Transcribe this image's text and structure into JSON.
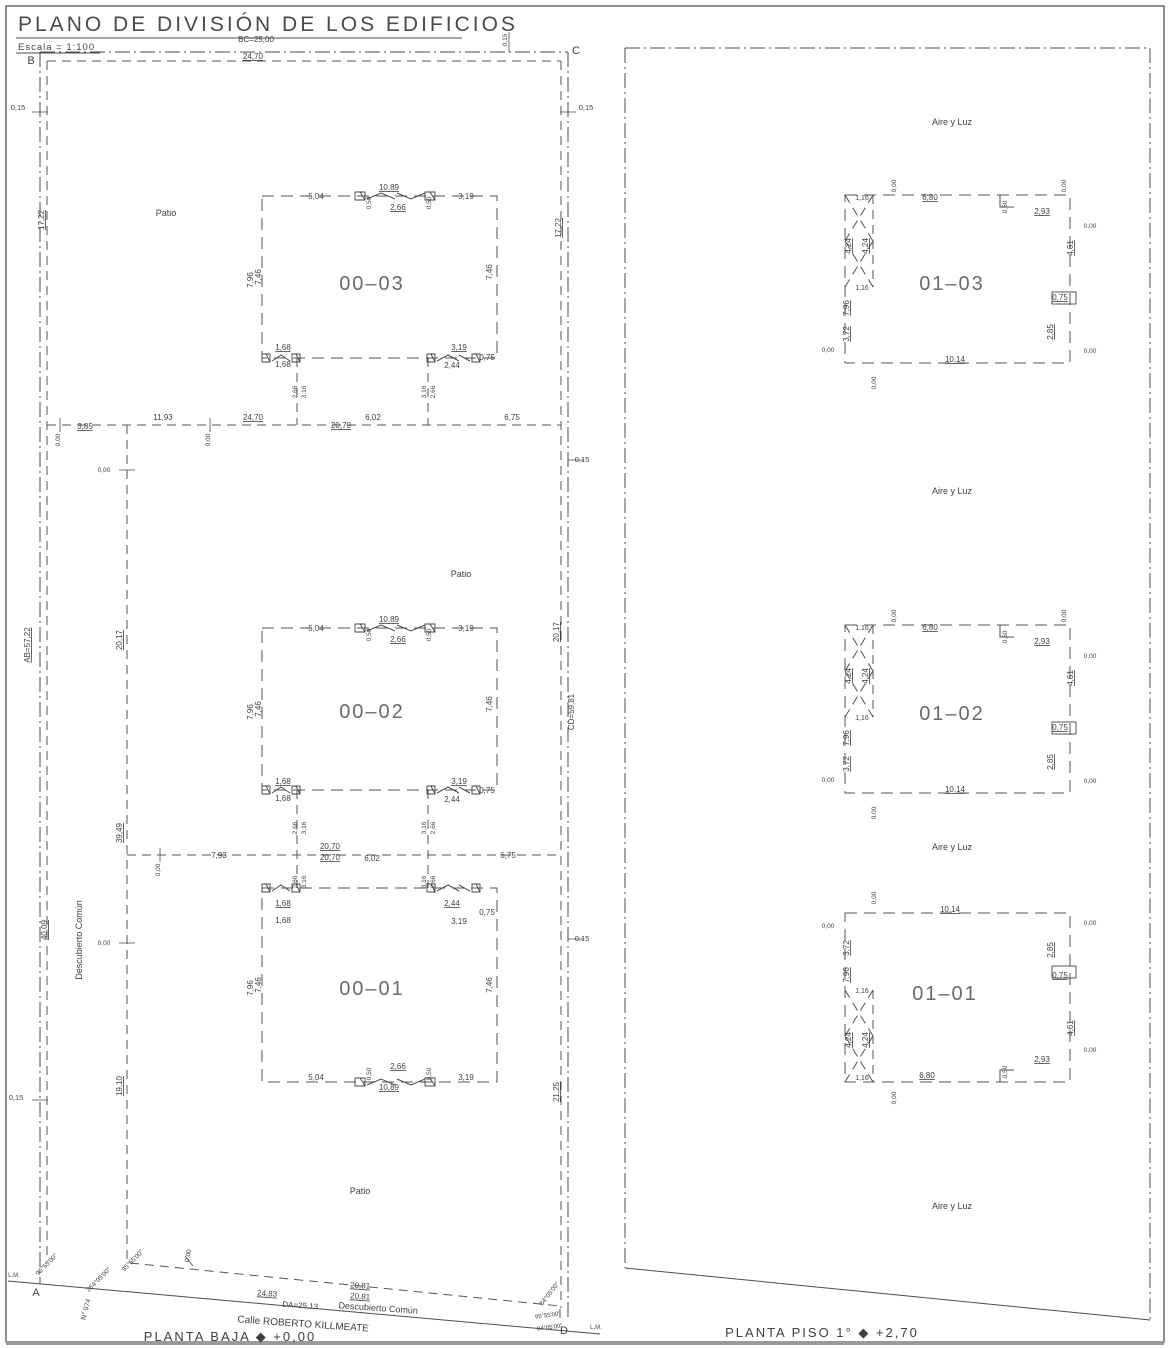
{
  "title": "PLANO DE DIVISIÓN DE LOS EDIFICIOS",
  "scale_label": "Escala = 1:100",
  "captions": {
    "left": "PLANTA BAJA ◆ +0,00",
    "right": "PLANTA PISO 1° ◆ +2,70"
  },
  "colors": {
    "ink": "#3f3f3f",
    "line": "#4d4d4d",
    "bg": "#ffffff"
  },
  "units_ground": [
    "00–01",
    "00–02",
    "00–03"
  ],
  "units_first": [
    "01–01",
    "01–02",
    "01–03"
  ],
  "labels": [
    {
      "t": "B",
      "x": 31,
      "y": 64,
      "s": 11,
      "n": "corner-b"
    },
    {
      "t": "C",
      "x": 576,
      "y": 54,
      "s": 11,
      "n": "corner-c"
    },
    {
      "t": "A",
      "x": 36,
      "y": 1296,
      "s": 11,
      "n": "corner-a"
    },
    {
      "t": "D",
      "x": 564,
      "y": 1334,
      "s": 11,
      "n": "corner-d"
    },
    {
      "t": "L.M.",
      "x": 14,
      "y": 1277,
      "s": 6,
      "n": "lm-left"
    },
    {
      "t": "L.M.",
      "x": 596,
      "y": 1329,
      "s": 6,
      "n": "lm-right"
    },
    {
      "t": "BC=25,00",
      "x": 256,
      "y": 42,
      "n": "dim-bc"
    },
    {
      "t": "24,70",
      "x": 253,
      "y": 59,
      "u": 1
    },
    {
      "t": "0,15",
      "x": 507,
      "y": 40,
      "r": -90,
      "s": 6.5
    },
    {
      "t": "0,15",
      "x": 18,
      "y": 110,
      "s": 7.5
    },
    {
      "t": "17,22",
      "x": 44,
      "y": 220,
      "r": -90,
      "u": 1
    },
    {
      "t": "AB=57,22",
      "x": 30,
      "y": 645,
      "r": -90,
      "u": 1,
      "n": "dim-ab"
    },
    {
      "t": "40,09",
      "x": 47,
      "y": 930,
      "r": -90,
      "u": 1
    },
    {
      "t": "0,15",
      "x": 16,
      "y": 1100,
      "s": 7.5
    },
    {
      "t": "Descubierto Común",
      "x": 82,
      "y": 940,
      "r": -90,
      "s": 9,
      "n": "area-descubierto-comun"
    },
    {
      "t": "0,15",
      "x": 586,
      "y": 110,
      "s": 7.5
    },
    {
      "t": "17,22",
      "x": 561,
      "y": 228,
      "r": -90,
      "u": 1
    },
    {
      "t": "0,15",
      "x": 582,
      "y": 462,
      "s": 7.5
    },
    {
      "t": "20,17",
      "x": 559,
      "y": 632,
      "r": -90,
      "u": 1
    },
    {
      "t": "CD=59,81",
      "x": 574,
      "y": 712,
      "r": -90,
      "n": "dim-cd"
    },
    {
      "t": "0,15",
      "x": 582,
      "y": 941,
      "s": 7.5
    },
    {
      "t": "21,25",
      "x": 559,
      "y": 1092,
      "r": -90,
      "u": 1
    },
    {
      "t": "3,85",
      "x": 85,
      "y": 429,
      "u": 1
    },
    {
      "t": "0,00",
      "x": 60,
      "y": 440,
      "r": -90,
      "s": 6.5
    },
    {
      "t": "11,93",
      "x": 163,
      "y": 420
    },
    {
      "t": "0,00",
      "x": 210,
      "y": 440,
      "r": -90,
      "s": 6.5
    },
    {
      "t": "24,70",
      "x": 253,
      "y": 420,
      "u": 1
    },
    {
      "t": "20,70",
      "x": 341,
      "y": 428,
      "u": 1
    },
    {
      "t": "6,02",
      "x": 373,
      "y": 420
    },
    {
      "t": "6,75",
      "x": 512,
      "y": 420
    },
    {
      "t": "0,00",
      "x": 104,
      "y": 472,
      "s": 6.5
    },
    {
      "t": "20,17",
      "x": 122,
      "y": 640,
      "r": -90,
      "u": 1
    },
    {
      "t": "39,49",
      "x": 122,
      "y": 833,
      "r": -90,
      "u": 1
    },
    {
      "t": "0,00",
      "x": 104,
      "y": 945,
      "s": 6.5
    },
    {
      "t": "19,10",
      "x": 122,
      "y": 1086,
      "r": -90,
      "u": 1
    },
    {
      "t": "0,00",
      "x": 160,
      "y": 870,
      "r": -90,
      "s": 6.5
    },
    {
      "t": "7,93",
      "x": 219,
      "y": 858
    },
    {
      "t": "20,70",
      "x": 330,
      "y": 849,
      "u": 1
    },
    {
      "t": "20,70",
      "x": 330,
      "y": 860,
      "u": 1
    },
    {
      "t": "6,02",
      "x": 372,
      "y": 861
    },
    {
      "t": "6,75",
      "x": 508,
      "y": 858
    },
    {
      "t": "2,66",
      "x": 297,
      "y": 392,
      "r": -90,
      "s": 6.5
    },
    {
      "t": "3,16",
      "x": 306,
      "y": 392,
      "r": -90,
      "s": 6.5
    },
    {
      "t": "3,16",
      "x": 426,
      "y": 392,
      "r": -90,
      "s": 6.5
    },
    {
      "t": "2,66",
      "x": 435,
      "y": 392,
      "r": -90,
      "s": 6.5
    },
    {
      "t": "2,66",
      "x": 297,
      "y": 828,
      "r": -90,
      "s": 6.5
    },
    {
      "t": "3,16",
      "x": 306,
      "y": 828,
      "r": -90,
      "s": 6.5
    },
    {
      "t": "3,16",
      "x": 426,
      "y": 828,
      "r": -90,
      "s": 6.5
    },
    {
      "t": "2,66",
      "x": 435,
      "y": 828,
      "r": -90,
      "s": 6.5
    },
    {
      "t": "2,66",
      "x": 297,
      "y": 882,
      "r": -90,
      "s": 6.5
    },
    {
      "t": "3,16",
      "x": 306,
      "y": 882,
      "r": -90,
      "s": 6.5
    },
    {
      "t": "3,16",
      "x": 426,
      "y": 882,
      "r": -90,
      "s": 6.5
    },
    {
      "t": "2,66",
      "x": 435,
      "y": 882,
      "r": -90,
      "s": 6.5
    },
    {
      "t": "5,04",
      "x": 316,
      "y": 199
    },
    {
      "t": "10,89",
      "x": 389,
      "y": 190,
      "u": 1
    },
    {
      "t": "0,50",
      "x": 371,
      "y": 203,
      "r": -90,
      "s": 6.5
    },
    {
      "t": "2,66",
      "x": 398,
      "y": 210,
      "u": 1
    },
    {
      "t": "0,50",
      "x": 431,
      "y": 203,
      "r": -90,
      "s": 6.5
    },
    {
      "t": "3,19",
      "x": 466,
      "y": 199
    },
    {
      "t": "7,96",
      "x": 253,
      "y": 280,
      "r": -90
    },
    {
      "t": "7,46",
      "x": 261,
      "y": 277,
      "r": -90
    },
    {
      "t": "7,46",
      "x": 492,
      "y": 272,
      "r": -90
    },
    {
      "t": "1,68",
      "x": 283,
      "y": 350,
      "u": 1
    },
    {
      "t": "1,68",
      "x": 283,
      "y": 367
    },
    {
      "t": "3,19",
      "x": 459,
      "y": 350,
      "u": 1
    },
    {
      "t": "2,44",
      "x": 452,
      "y": 368
    },
    {
      "t": "0,75",
      "x": 487,
      "y": 360
    },
    {
      "t": "00–03",
      "x": 372,
      "y": 290,
      "s": 20,
      "n": "unit-label-00-03"
    },
    {
      "t": "5,04",
      "x": 316,
      "y": 631
    },
    {
      "t": "10,89",
      "x": 389,
      "y": 622,
      "u": 1
    },
    {
      "t": "0,50",
      "x": 371,
      "y": 635,
      "r": -90,
      "s": 6.5
    },
    {
      "t": "2,66",
      "x": 398,
      "y": 642,
      "u": 1
    },
    {
      "t": "0,50",
      "x": 431,
      "y": 635,
      "r": -90,
      "s": 6.5
    },
    {
      "t": "3,19",
      "x": 466,
      "y": 631
    },
    {
      "t": "7,96",
      "x": 253,
      "y": 712,
      "r": -90
    },
    {
      "t": "7,46",
      "x": 261,
      "y": 709,
      "r": -90
    },
    {
      "t": "7,46",
      "x": 492,
      "y": 704,
      "r": -90
    },
    {
      "t": "1,68",
      "x": 283,
      "y": 784,
      "u": 1
    },
    {
      "t": "1,68",
      "x": 283,
      "y": 801
    },
    {
      "t": "3,19",
      "x": 459,
      "y": 784,
      "u": 1
    },
    {
      "t": "2,44",
      "x": 452,
      "y": 802
    },
    {
      "t": "0,75",
      "x": 487,
      "y": 793
    },
    {
      "t": "00–02",
      "x": 372,
      "y": 718,
      "s": 20,
      "n": "unit-label-00-02"
    },
    {
      "t": "1,68",
      "x": 283,
      "y": 906,
      "u": 1
    },
    {
      "t": "1,68",
      "x": 283,
      "y": 923
    },
    {
      "t": "2,44",
      "x": 452,
      "y": 906,
      "u": 1
    },
    {
      "t": "3,19",
      "x": 459,
      "y": 924
    },
    {
      "t": "0,75",
      "x": 487,
      "y": 915
    },
    {
      "t": "7,96",
      "x": 253,
      "y": 988,
      "r": -90
    },
    {
      "t": "7,46",
      "x": 261,
      "y": 985,
      "r": -90
    },
    {
      "t": "7,46",
      "x": 492,
      "y": 985,
      "r": -90
    },
    {
      "t": "5,04",
      "x": 316,
      "y": 1080
    },
    {
      "t": "2,66",
      "x": 398,
      "y": 1069,
      "u": 1
    },
    {
      "t": "0,50",
      "x": 371,
      "y": 1074,
      "r": -90,
      "s": 6.5
    },
    {
      "t": "0,50",
      "x": 431,
      "y": 1074,
      "r": -90,
      "s": 6.5
    },
    {
      "t": "10,89",
      "x": 389,
      "y": 1090,
      "u": 1
    },
    {
      "t": "3,19",
      "x": 466,
      "y": 1080
    },
    {
      "t": "00–01",
      "x": 372,
      "y": 995,
      "s": 20,
      "n": "unit-label-00-01"
    },
    {
      "t": "Patio",
      "x": 166,
      "y": 216,
      "s": 9,
      "n": "area-patio-1"
    },
    {
      "t": "Patio",
      "x": 461,
      "y": 577,
      "s": 9,
      "n": "area-patio-2"
    },
    {
      "t": "Patio",
      "x": 360,
      "y": 1194,
      "s": 9,
      "n": "area-patio-3"
    },
    {
      "t": "0,00",
      "x": 190,
      "y": 1256,
      "r": -80,
      "s": 6.5
    },
    {
      "t": "95°55'00\"",
      "x": 48,
      "y": 1266,
      "r": -45,
      "s": 6.5
    },
    {
      "t": "264°05'00\"",
      "x": 100,
      "y": 1281,
      "r": -45,
      "s": 6.5
    },
    {
      "t": "95°55'00\"",
      "x": 134,
      "y": 1262,
      "r": -45,
      "s": 6.5
    },
    {
      "t": "N° 974",
      "x": 88,
      "y": 1310,
      "r": -75,
      "s": 7,
      "n": "street-number"
    },
    {
      "t": "24,83",
      "x": 267,
      "y": 1296,
      "u": 1,
      "r": 4
    },
    {
      "t": "DA=25,13",
      "x": 300,
      "y": 1308,
      "r": 4,
      "n": "dim-da"
    },
    {
      "t": "Calle ROBERTO KILLMEATE",
      "x": 303,
      "y": 1327,
      "r": 4,
      "s": 10,
      "n": "street-name"
    },
    {
      "t": "Descubierto Común",
      "x": 378,
      "y": 1311,
      "r": 4,
      "s": 9,
      "n": "area-descubierto-comun-2"
    },
    {
      "t": "20,81",
      "x": 360,
      "y": 1288,
      "u": 1,
      "r": 4
    },
    {
      "t": "20,81",
      "x": 360,
      "y": 1299,
      "u": 1,
      "r": 4
    },
    {
      "t": "84°05'00\"",
      "x": 551,
      "y": 1295,
      "r": -52,
      "s": 6.5
    },
    {
      "t": "95°55'00\"",
      "x": 548,
      "y": 1317,
      "r": -8,
      "s": 6
    },
    {
      "t": "84°05'00\"",
      "x": 550,
      "y": 1329,
      "r": -8,
      "s": 6
    },
    {
      "t": "Aire y Luz",
      "x": 952,
      "y": 125,
      "s": 9,
      "n": "area-aire-y-luz-1"
    },
    {
      "t": "Aire y Luz",
      "x": 952,
      "y": 494,
      "s": 9,
      "n": "area-aire-y-luz-2"
    },
    {
      "t": "Aire y Luz",
      "x": 952,
      "y": 850,
      "s": 9,
      "n": "area-aire-y-luz-3"
    },
    {
      "t": "Aire y Luz",
      "x": 952,
      "y": 1209,
      "s": 9,
      "n": "area-aire-y-luz-4"
    },
    {
      "t": "1,16",
      "x": 862,
      "y": 200,
      "s": 7
    },
    {
      "t": "0,00",
      "x": 896,
      "y": 186,
      "r": -90,
      "s": 6.5
    },
    {
      "t": "6,80",
      "x": 930,
      "y": 200,
      "u": 1
    },
    {
      "t": "0,50",
      "x": 1007,
      "y": 207,
      "r": -90,
      "s": 6.5
    },
    {
      "t": "2,93",
      "x": 1042,
      "y": 214,
      "u": 1
    },
    {
      "t": "0,00",
      "x": 1066,
      "y": 186,
      "r": -90,
      "s": 6.5
    },
    {
      "t": "0,00",
      "x": 1090,
      "y": 228,
      "s": 6.5
    },
    {
      "t": "4,61",
      "x": 1073,
      "y": 248,
      "r": -90,
      "u": 1
    },
    {
      "t": "0,75",
      "x": 1060,
      "y": 300,
      "u": 1
    },
    {
      "t": "2,85",
      "x": 1053,
      "y": 332,
      "r": -90,
      "u": 1
    },
    {
      "t": "0,00",
      "x": 1090,
      "y": 353,
      "s": 6.5
    },
    {
      "t": "10,14",
      "x": 955,
      "y": 362,
      "u": 1
    },
    {
      "t": "0,00",
      "x": 876,
      "y": 383,
      "r": -90,
      "s": 6.5
    },
    {
      "t": "4,24",
      "x": 851,
      "y": 246,
      "r": -90,
      "u": 1
    },
    {
      "t": "4,24",
      "x": 868,
      "y": 246,
      "r": -90,
      "u": 1
    },
    {
      "t": "1,16",
      "x": 862,
      "y": 290,
      "s": 7
    },
    {
      "t": "7,96",
      "x": 849,
      "y": 308,
      "r": -90,
      "u": 1
    },
    {
      "t": "3,72",
      "x": 849,
      "y": 334,
      "r": -90,
      "u": 1
    },
    {
      "t": "0,00",
      "x": 828,
      "y": 352,
      "s": 6.5
    },
    {
      "t": "01–03",
      "x": 952,
      "y": 290,
      "s": 20,
      "n": "unit-label-01-03"
    },
    {
      "t": "1,16",
      "x": 862,
      "y": 630,
      "s": 7
    },
    {
      "t": "0,00",
      "x": 896,
      "y": 616,
      "r": -90,
      "s": 6.5
    },
    {
      "t": "6,80",
      "x": 930,
      "y": 630,
      "u": 1
    },
    {
      "t": "0,50",
      "x": 1007,
      "y": 637,
      "r": -90,
      "s": 6.5
    },
    {
      "t": "2,93",
      "x": 1042,
      "y": 644,
      "u": 1
    },
    {
      "t": "0,00",
      "x": 1066,
      "y": 616,
      "r": -90,
      "s": 6.5
    },
    {
      "t": "0,00",
      "x": 1090,
      "y": 658,
      "s": 6.5
    },
    {
      "t": "4,61",
      "x": 1073,
      "y": 678,
      "r": -90,
      "u": 1
    },
    {
      "t": "0,75",
      "x": 1060,
      "y": 730,
      "u": 1
    },
    {
      "t": "2,85",
      "x": 1053,
      "y": 762,
      "r": -90,
      "u": 1
    },
    {
      "t": "0,00",
      "x": 1090,
      "y": 783,
      "s": 6.5
    },
    {
      "t": "10,14",
      "x": 955,
      "y": 792,
      "u": 1
    },
    {
      "t": "0,00",
      "x": 876,
      "y": 813,
      "r": -90,
      "s": 6.5
    },
    {
      "t": "4,24",
      "x": 851,
      "y": 676,
      "r": -90,
      "u": 1
    },
    {
      "t": "4,24",
      "x": 868,
      "y": 676,
      "r": -90,
      "u": 1
    },
    {
      "t": "1,16",
      "x": 862,
      "y": 720,
      "s": 7
    },
    {
      "t": "7,96",
      "x": 849,
      "y": 738,
      "r": -90,
      "u": 1
    },
    {
      "t": "3,72",
      "x": 849,
      "y": 764,
      "r": -90,
      "u": 1
    },
    {
      "t": "0,00",
      "x": 828,
      "y": 782,
      "s": 6.5
    },
    {
      "t": "01–02",
      "x": 952,
      "y": 720,
      "s": 20,
      "n": "unit-label-01-02"
    },
    {
      "t": "0,00",
      "x": 876,
      "y": 898,
      "r": -90,
      "s": 6.5
    },
    {
      "t": "10,14",
      "x": 950,
      "y": 912,
      "u": 1
    },
    {
      "t": "0,00",
      "x": 1090,
      "y": 925,
      "s": 6.5
    },
    {
      "t": "2,85",
      "x": 1053,
      "y": 950,
      "r": -90,
      "u": 1
    },
    {
      "t": "0,75",
      "x": 1060,
      "y": 978,
      "u": 1
    },
    {
      "t": "4,61",
      "x": 1073,
      "y": 1028,
      "r": -90,
      "u": 1
    },
    {
      "t": "0,00",
      "x": 1090,
      "y": 1052,
      "s": 6.5
    },
    {
      "t": "2,93",
      "x": 1042,
      "y": 1062,
      "u": 1
    },
    {
      "t": "0,50",
      "x": 1007,
      "y": 1072,
      "r": -90,
      "s": 6.5
    },
    {
      "t": "6,80",
      "x": 927,
      "y": 1078,
      "u": 1
    },
    {
      "t": "0,00",
      "x": 896,
      "y": 1098,
      "r": -90,
      "s": 6.5
    },
    {
      "t": "0,00",
      "x": 828,
      "y": 928,
      "s": 6.5
    },
    {
      "t": "3,72",
      "x": 849,
      "y": 948,
      "r": -90,
      "u": 1
    },
    {
      "t": "7,96",
      "x": 849,
      "y": 975,
      "r": -90,
      "u": 1
    },
    {
      "t": "1,16",
      "x": 862,
      "y": 993,
      "s": 7
    },
    {
      "t": "4,24",
      "x": 851,
      "y": 1040,
      "r": -90,
      "u": 1
    },
    {
      "t": "4,24",
      "x": 868,
      "y": 1040,
      "r": -90,
      "u": 1
    },
    {
      "t": "1,16",
      "x": 862,
      "y": 1080,
      "s": 7
    },
    {
      "t": "01–01",
      "x": 945,
      "y": 1000,
      "s": 20,
      "n": "unit-label-01-01"
    }
  ]
}
